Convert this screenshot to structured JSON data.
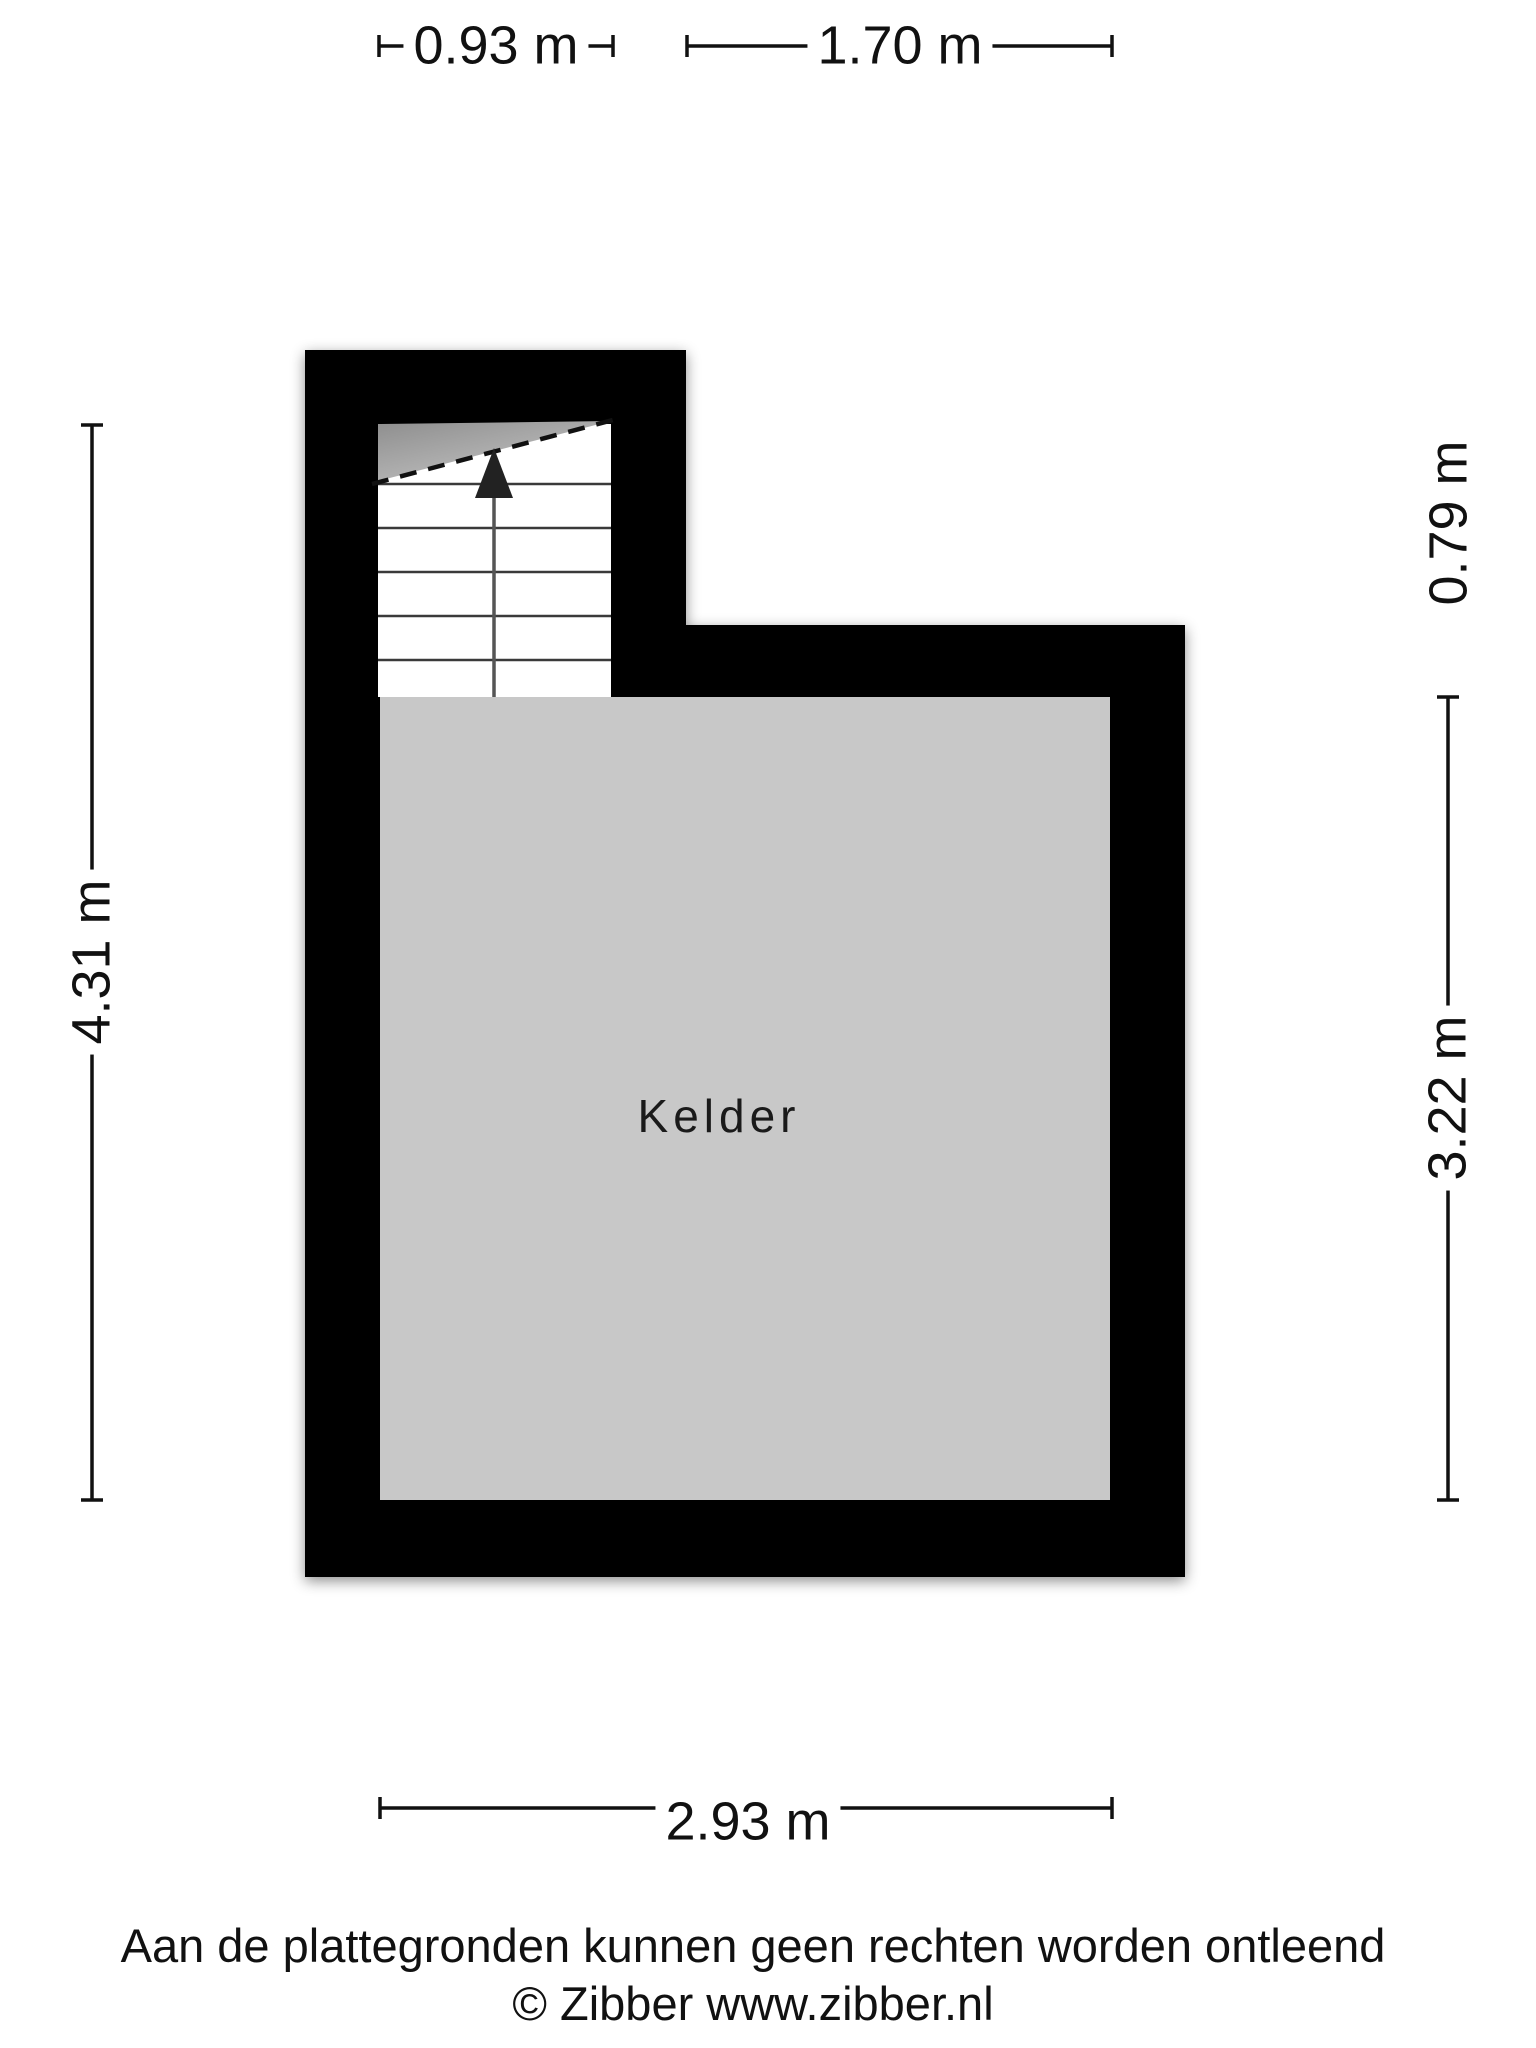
{
  "plan": {
    "room": {
      "label": "Kelder"
    },
    "stair": {
      "direction": "up"
    },
    "colors": {
      "wall": "#000000",
      "floor": "#c8c8c8",
      "stair_background": "#ffffff",
      "headroom_triangle_dark": "#8e8e8e",
      "headroom_triangle_light": "#c6c6c6",
      "line": "#111111"
    }
  },
  "dimensions": {
    "top_left": "0.93 m",
    "top_right": "1.70 m",
    "left": "4.31 m",
    "right_upper": "0.79 m",
    "right_lower": "3.22 m",
    "bottom": "2.93 m"
  },
  "footer": {
    "disclaimer": "Aan de plattegronden kunnen geen rechten worden ontleend",
    "copyright": "© Zibber www.zibber.nl"
  }
}
